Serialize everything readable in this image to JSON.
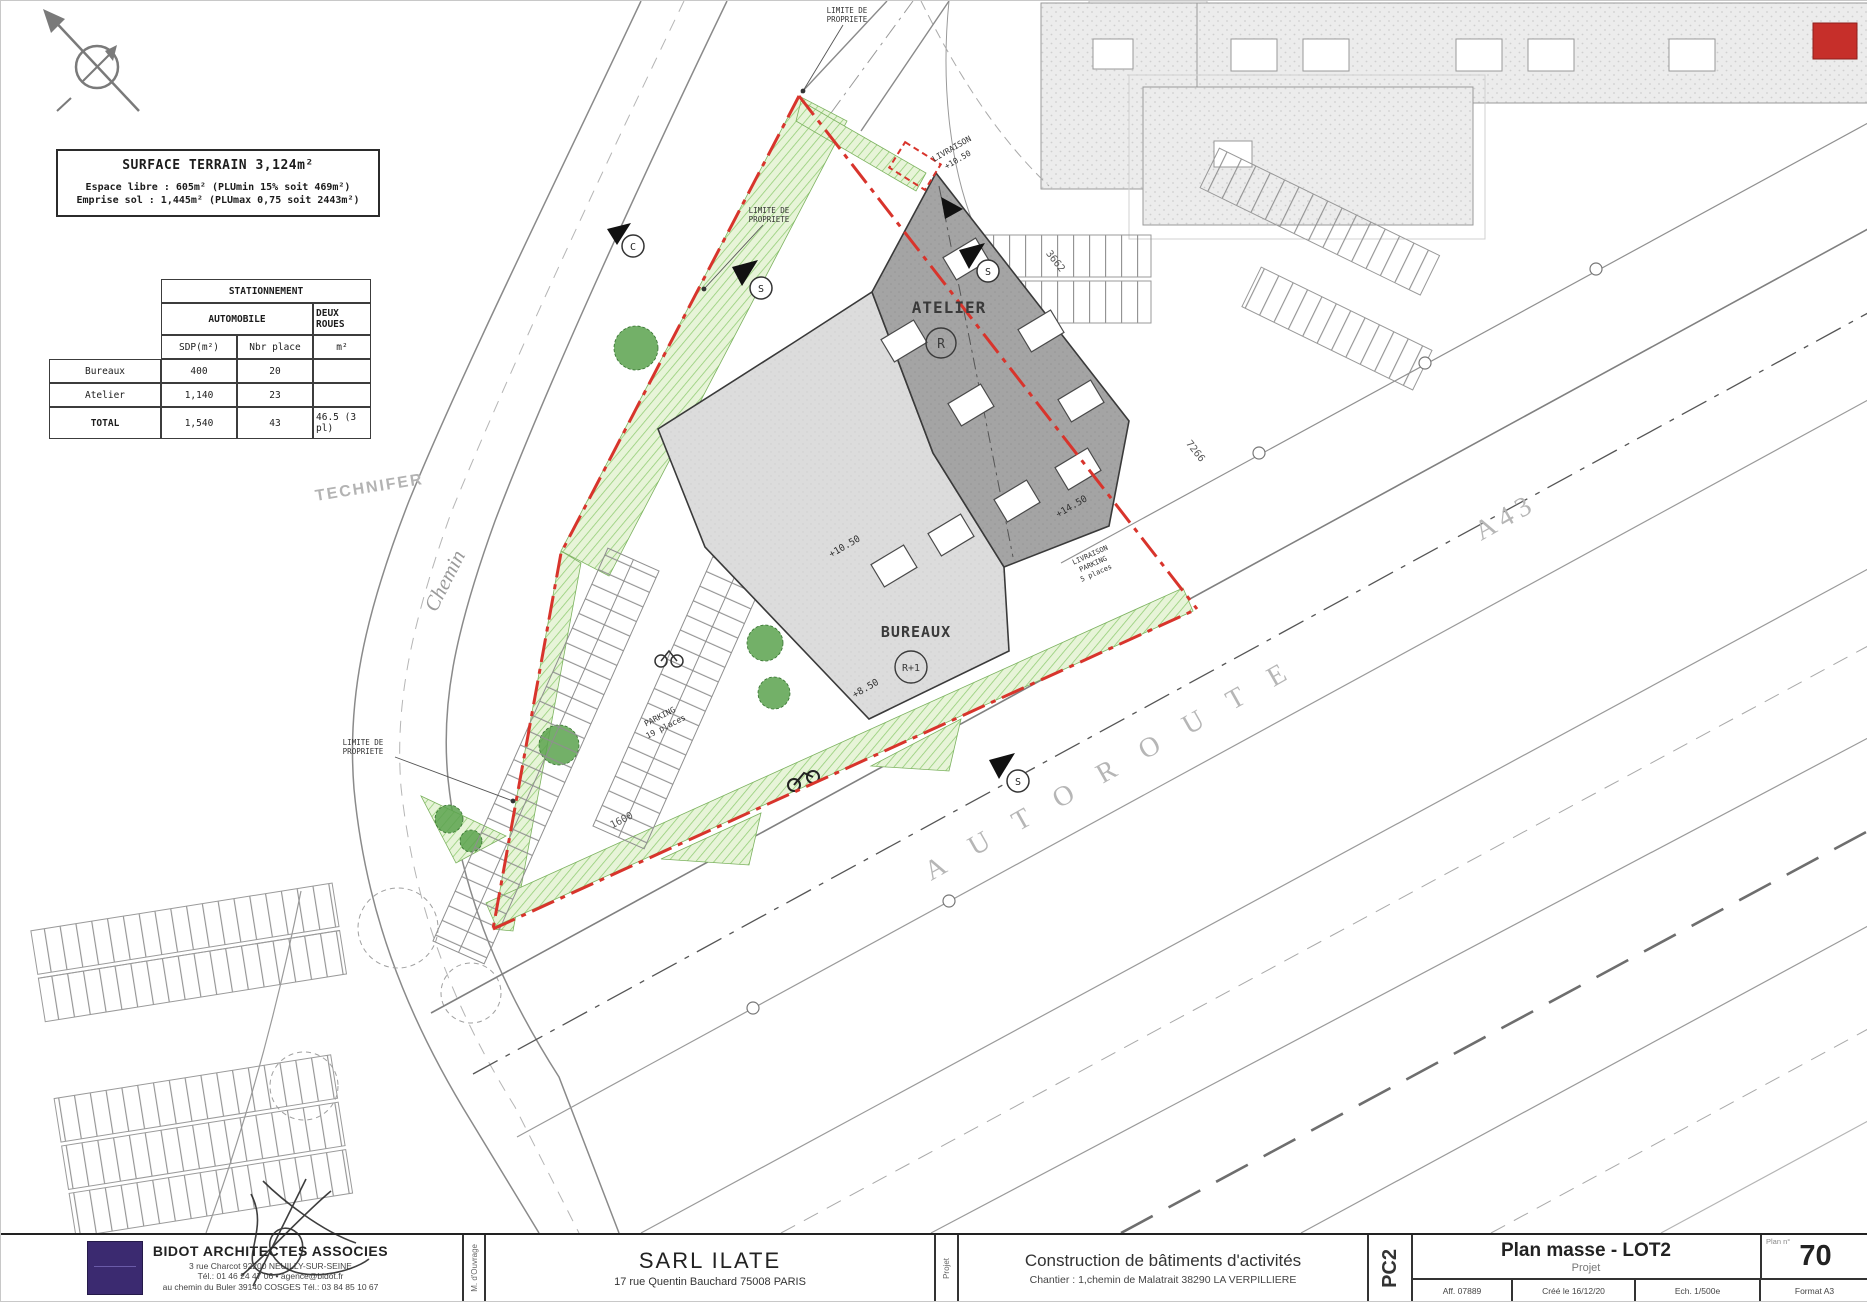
{
  "legend": {
    "title": "SURFACE TERRAIN  3,124m²",
    "line1": "Espace libre : 605m² (PLUmin 15% soit 469m²)",
    "line2": "Emprise sol : 1,445m² (PLUmax 0,75 soit 2443m²)"
  },
  "parking_table": {
    "title": "STATIONNEMENT",
    "group_auto": "AUTOMOBILE",
    "group_deux_roues": "DEUX ROUES",
    "col_sdp": "SDP(m²)",
    "col_places": "Nbr place",
    "col_m2": "m²",
    "rows": [
      {
        "label": "Bureaux",
        "sdp": "400",
        "places": "20",
        "m2": ""
      },
      {
        "label": "Atelier",
        "sdp": "1,140",
        "places": "23",
        "m2": ""
      },
      {
        "label": "TOTAL",
        "sdp": "1,540",
        "places": "43",
        "m2": "46.5 (3 pl)"
      }
    ]
  },
  "plan": {
    "labels": {
      "atelier": "ATELIER",
      "atelier_level": "R",
      "bureaux": "BUREAUX",
      "bureaux_level": "R+1",
      "technifer": "TECHNIFER",
      "chemin": "Chemin",
      "autoroute": "AUTOROUTE",
      "a43": "A43",
      "limite_1": "LIMITE DE",
      "limite_2": "PROPRIETE",
      "livraison": "LIVRAISON",
      "livraison_level": "+10.50",
      "level_bureaux": "+10.50",
      "level_atelier": "+14.50",
      "level_south": "+8.50",
      "parking_1": "PARKING",
      "parking_2": "19 places",
      "livparking_1": "LIVRAISON",
      "livparking_2": "PARKING",
      "livparking_3": "5 places",
      "dim_ne": "3662",
      "dim_e": "7266",
      "dim_sw": "1600",
      "marker_s": "S",
      "marker_c": "C"
    },
    "colors": {
      "boundary_red": "#d8342c",
      "landscape_green": "#94ce77",
      "building_dark": "#a4a4a4",
      "building_light": "#dcdcdc",
      "logo_purple": "#3b2a70",
      "line_gray": "#808080"
    }
  },
  "title_block": {
    "architect": {
      "name": "BIDOT ARCHITECTES ASSOCIES",
      "address": "3 rue Charcot 92200 NEUILLY-SUR-SEINE",
      "contact": "Tél.: 01 46 24 47 06  •  agence@bidot.fr",
      "contact2": "au chemin du Buler 39140 COSGES  Tél.: 03 84 85 10 67"
    },
    "role_owner": "M. d'Ouvrage",
    "client": {
      "name": "SARL ILATE",
      "address": "17 rue Quentin Bauchard   75008 PARIS"
    },
    "role_project": "Projet",
    "project": {
      "title": "Construction de bâtiments d'activités",
      "site": "Chantier :  1,chemin de Malatrait 38290 LA VERPILLIERE"
    },
    "phase": "PC2",
    "sheet": {
      "title": "Plan masse - LOT2",
      "subtitle": "Projet",
      "plan_no_label": "Plan n°",
      "plan_no": "70"
    },
    "footer": {
      "aff": "Aff.  07889",
      "created": "Créé le 16/12/20",
      "scale": "Ech. 1/500e",
      "format": "Format A3"
    }
  }
}
